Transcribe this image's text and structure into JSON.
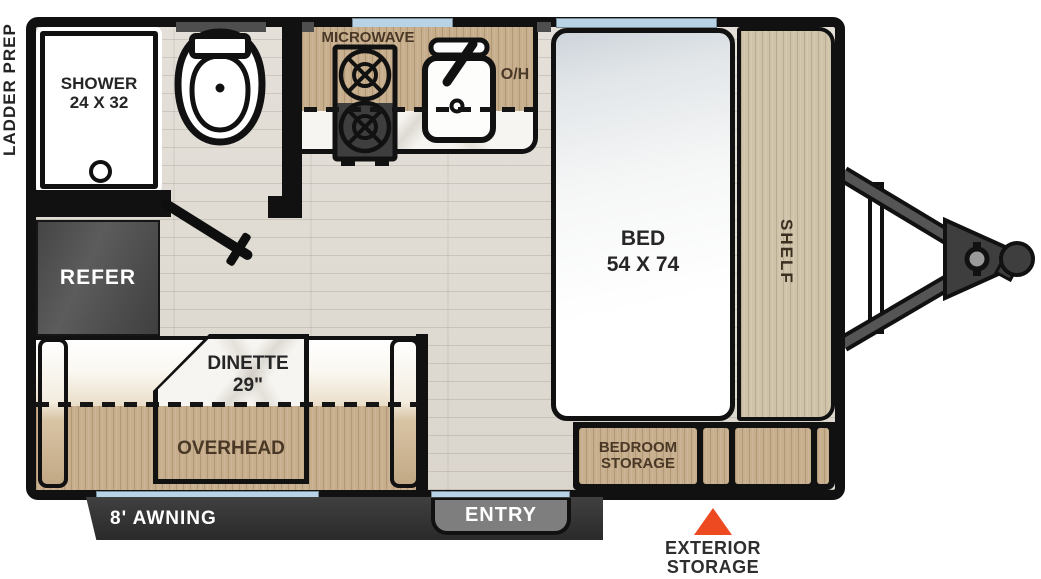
{
  "floorplan": {
    "labels": {
      "ladder_prep": "LADDER PREP",
      "mirror": "MIRROR",
      "shower": [
        "SHOWER",
        "24 X 32"
      ],
      "microwave": "MICROWAVE",
      "overhead_cabinet_abbr": "O/H",
      "bed": [
        "BED",
        "54 X 74"
      ],
      "shelf": "SHELF",
      "refer": "REFER",
      "dinette": [
        "DINETTE",
        "29\""
      ],
      "overhead": "OVERHEAD",
      "bedroom_storage": [
        "BEDROOM",
        "STORAGE"
      ],
      "awning": "8' AWNING",
      "entry": "ENTRY",
      "exterior_storage": [
        "EXTERIOR",
        "STORAGE"
      ]
    },
    "colors": {
      "wall_black": "#111111",
      "window_glass": "#b9d3e6",
      "cabinet_wood": "#c7ae8d",
      "shelf_wood": "#cfc3aa",
      "floor_laminate": "#e0dcd4",
      "refrigerator_gray": "#4c4c4c",
      "awning_bar": "#333333",
      "entry_step_gray": "#7e7e7e",
      "storage_marker_orange": "#ee4a22",
      "wood_label_text": "#4a3827",
      "dark_label_text": "#262626"
    },
    "icons": {
      "toilet": "toilet-icon (svg shapes)",
      "sink": "sink-icon (svg shapes)",
      "stove": "stove-burners-icon (svg shapes)",
      "shower_drain": "drain-icon (css circle)",
      "bath_door": "door-swing-icon (rotated bar)",
      "hitch": "trailer-tongue-icon (svg shapes)",
      "exterior_storage_marker": "triangle-marker-icon (css triangle)"
    }
  }
}
